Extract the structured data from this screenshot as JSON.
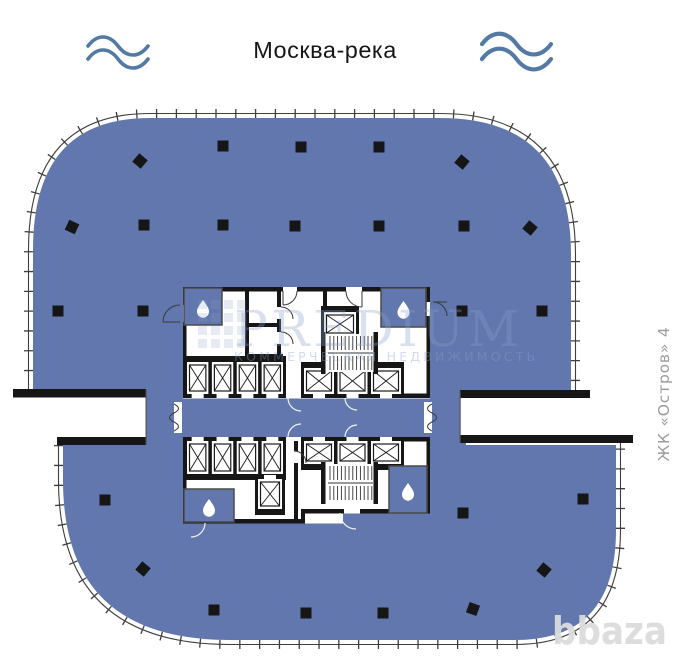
{
  "title": {
    "river_label": "Москва-река"
  },
  "labels": {
    "side_vertical": "ЖК «Остров» 4",
    "site_watermark": "bbaza"
  },
  "watermark": {
    "brand": "PREDIUM",
    "tagline": "КОММЕРЧЕСКАЯ НЕДВИЖИМОСТЬ"
  },
  "colors": {
    "floor_fill": "#6277ae",
    "wall": "#161616",
    "facade_line": "#3e3e3e",
    "wave": "#527aa4",
    "side_label": "#9c9c9c",
    "watermark_text": "#8ba1c9"
  },
  "plan": {
    "columns_square": [
      [
        223,
        146
      ],
      [
        301,
        147
      ],
      [
        379,
        147
      ],
      [
        144,
        225
      ],
      [
        223,
        225
      ],
      [
        295,
        226
      ],
      [
        379,
        226
      ],
      [
        464,
        226
      ],
      [
        58,
        311
      ],
      [
        143,
        311
      ],
      [
        462,
        311
      ],
      [
        542,
        311
      ],
      [
        105,
        500
      ],
      [
        463,
        513
      ],
      [
        583,
        499
      ],
      [
        214,
        610
      ],
      [
        306,
        613
      ],
      [
        383,
        613
      ]
    ],
    "columns_rotated": [
      [
        140,
        161,
        40
      ],
      [
        462,
        162,
        40
      ],
      [
        72,
        227,
        25
      ],
      [
        530,
        228,
        40
      ],
      [
        143,
        569,
        40
      ],
      [
        544,
        570,
        40
      ],
      [
        473,
        609,
        20
      ]
    ],
    "elevator_banks": [
      {
        "x": 184,
        "y": 356,
        "w": 102,
        "h": 42,
        "cells": 4,
        "door": "bottom"
      },
      {
        "x": 184,
        "y": 437,
        "w": 102,
        "h": 43,
        "cells": 4,
        "door": "top"
      },
      {
        "x": 301,
        "y": 362,
        "w": 103,
        "h": 36,
        "cells": 3,
        "door": "bottom"
      },
      {
        "x": 301,
        "y": 437,
        "w": 103,
        "h": 33,
        "cells": 3,
        "door": "top"
      },
      {
        "x": 321,
        "y": 306,
        "w": 38,
        "h": 34,
        "cells": 1,
        "door": "bottom"
      },
      {
        "x": 255,
        "y": 475,
        "w": 30,
        "h": 40,
        "cells": 1,
        "door": "top"
      }
    ],
    "stairs": [
      {
        "x": 321,
        "y": 334,
        "w": 55,
        "h": 38
      },
      {
        "x": 321,
        "y": 464,
        "w": 55,
        "h": 38
      }
    ],
    "wc_rooms": [
      {
        "x": 184,
        "y": 288,
        "w": 38,
        "h": 37
      },
      {
        "x": 381,
        "y": 288,
        "w": 45,
        "h": 39
      },
      {
        "x": 184,
        "y": 489,
        "w": 50,
        "h": 33
      },
      {
        "x": 389,
        "y": 466,
        "w": 38,
        "h": 47
      }
    ]
  }
}
